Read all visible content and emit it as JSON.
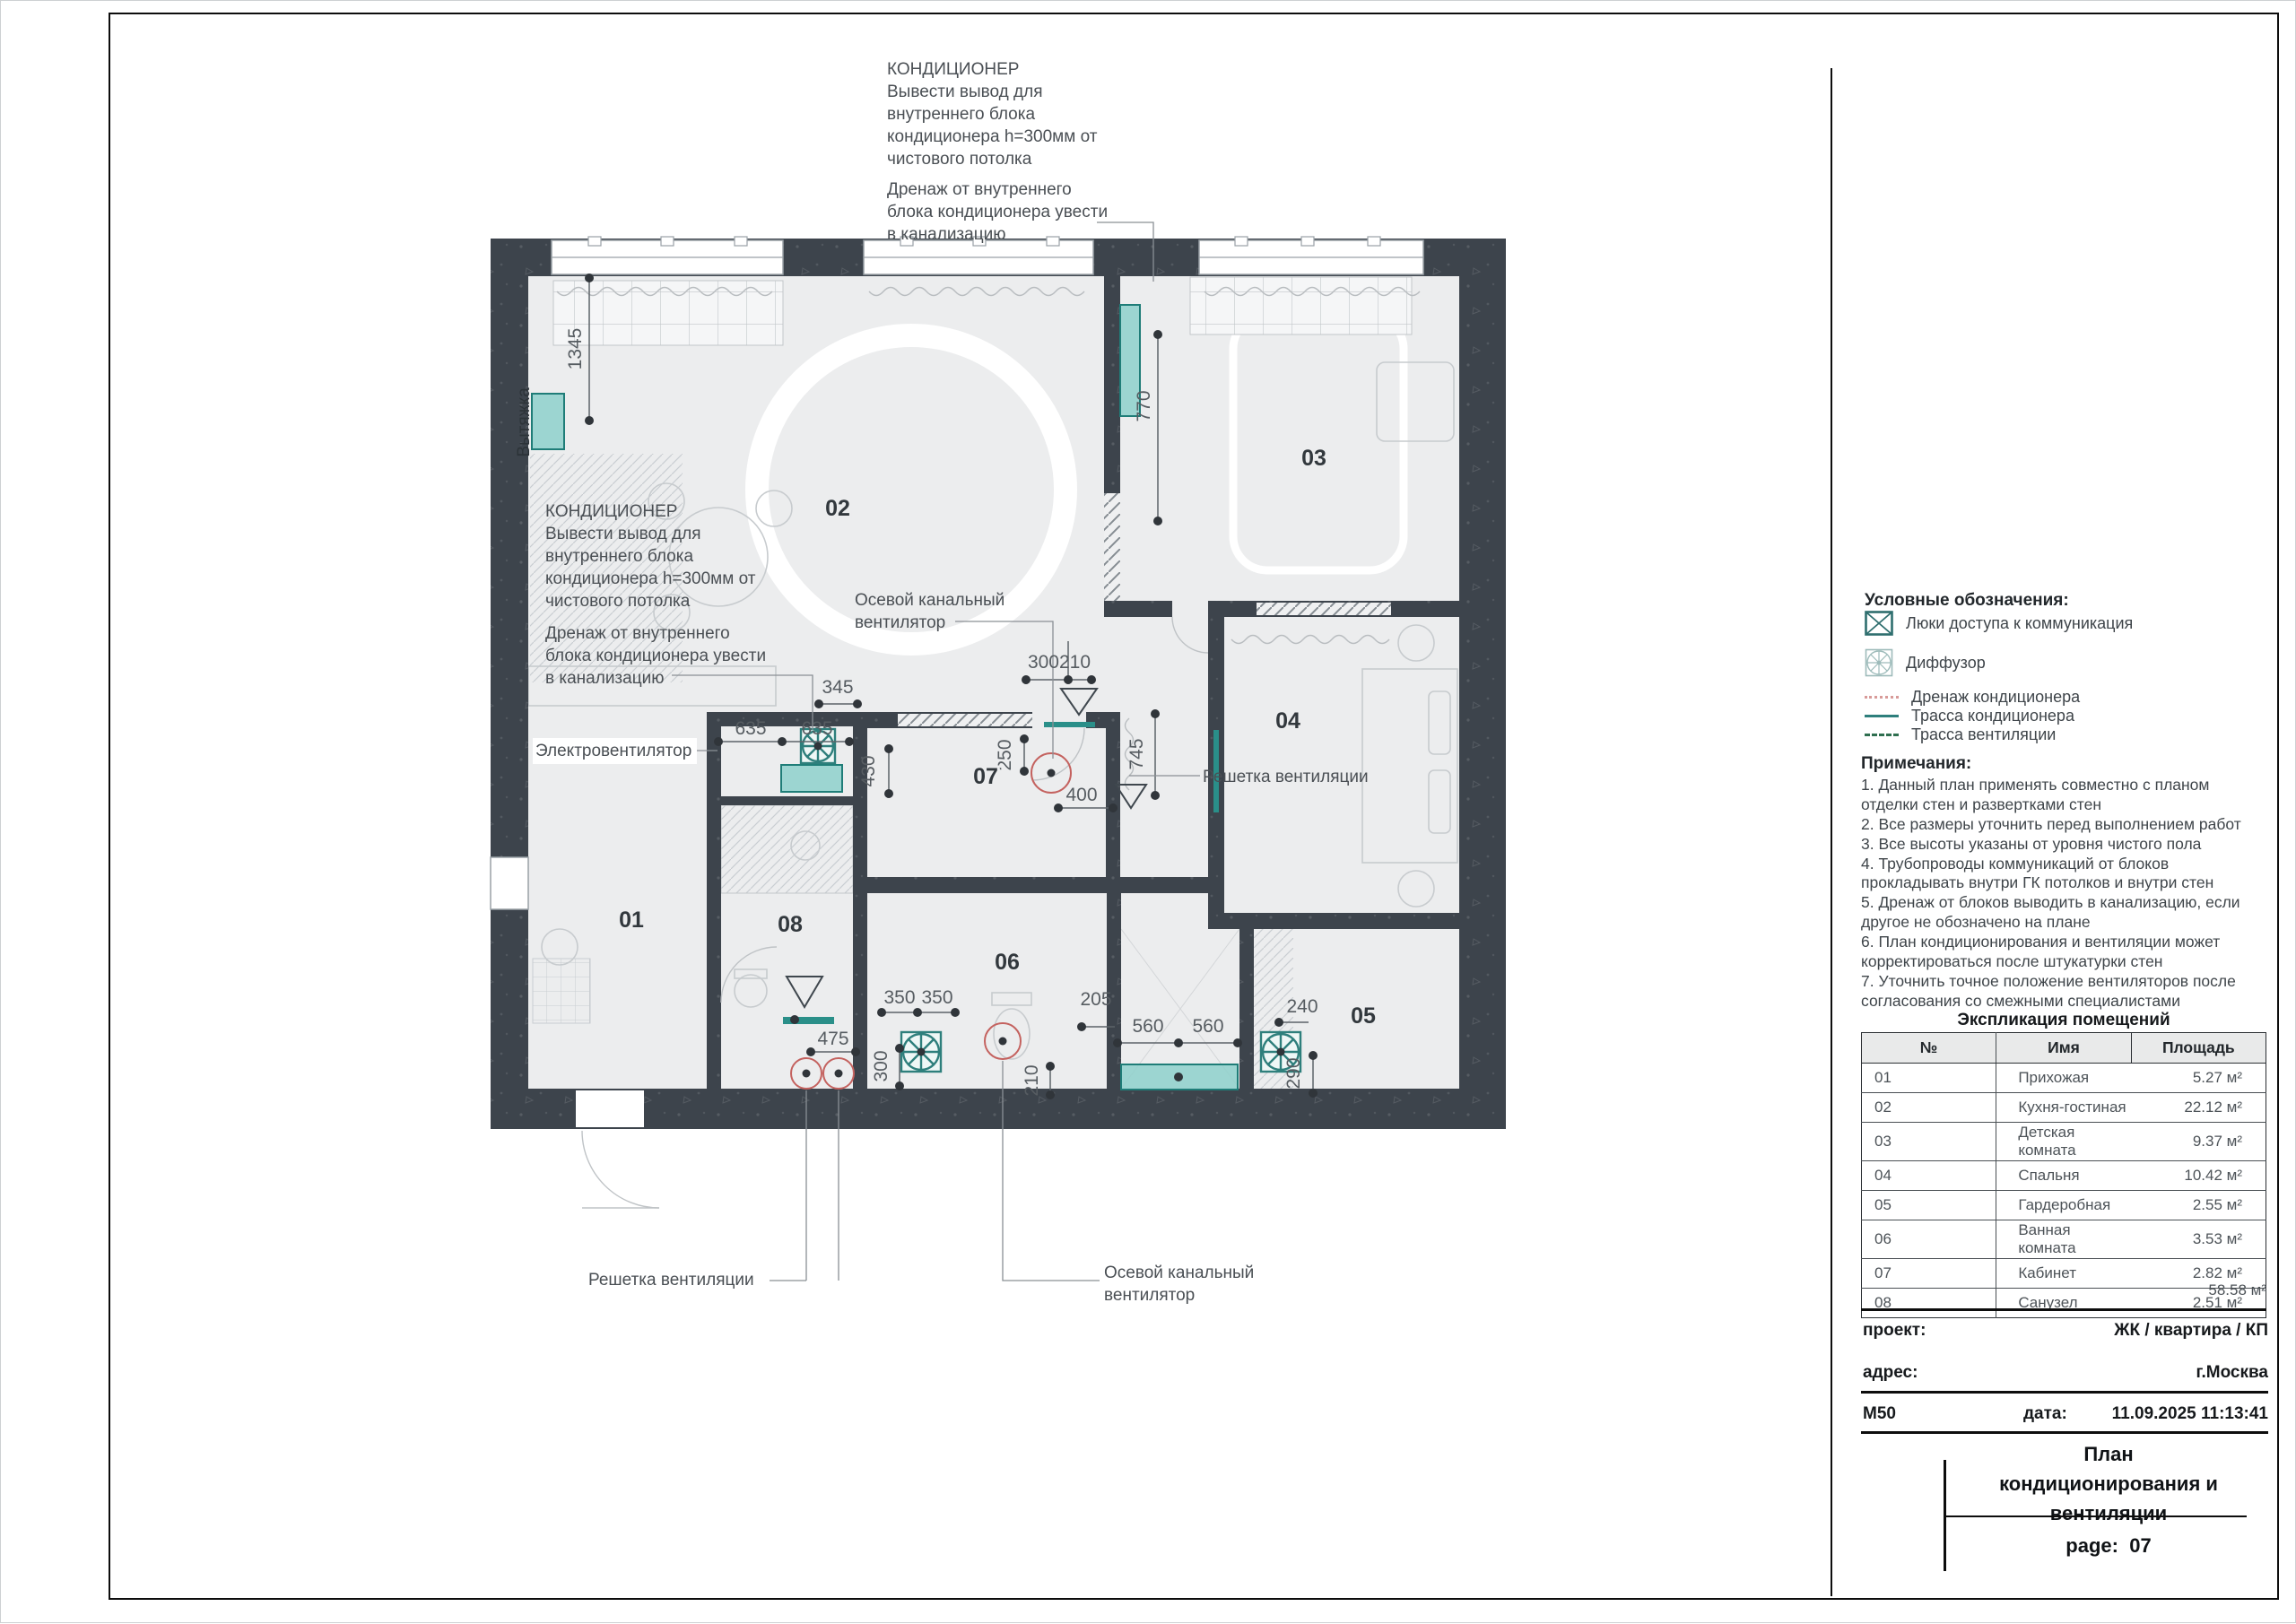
{
  "colors": {
    "wall": "#3d444c",
    "floor": "#ecedee",
    "teal_stroke": "#1f7d78",
    "teal_fill": "#8ed0cb",
    "red_marker": "#c4625f"
  },
  "plan": {
    "rooms": {
      "r01": "01",
      "r02": "02",
      "r03": "03",
      "r04": "04",
      "r05": "05",
      "r06": "06",
      "r07": "07",
      "r08": "08"
    },
    "dims": {
      "d1345": "1345",
      "d770": "770",
      "d345": "345",
      "d635a": "635",
      "d635b": "635",
      "d430": "430",
      "d250": "250",
      "d300210": "300210",
      "d400": "400",
      "d745": "745",
      "d350a": "350",
      "d350b": "350",
      "d300": "300",
      "d475": "475",
      "d205": "205",
      "d210": "210",
      "d560a": "560",
      "d560b": "560",
      "d240": "240",
      "d290": "290"
    },
    "labels": {
      "vytyazhka": "Вытяжка"
    }
  },
  "annotations": {
    "ac_top": "КОНДИЦИОНЕР\nВывести вывод для\nвнутреннего блока\nкондиционера h=300мм от\nчистового потолка",
    "drain_top": "Дренаж от внутреннего\nблока кондиционера увести\nв канализацию",
    "ac_left": "КОНДИЦИОНЕР\nВывести вывод для\nвнутреннего блока\nкондиционера h=300мм от\nчистового потолка",
    "drain_left": "Дренаж от внутреннего\nблока кондиционера увести\nв канализацию",
    "electro_fan": "Электровентилятор",
    "axial_fan_mid": "Осевой канальный\nвентилятор",
    "axial_fan_bottom": "Осевой канальный\nвентилятор",
    "vent_grille_right": "Решетка вентиляции",
    "vent_grille_bottom": "Решетка вентиляции"
  },
  "legend": {
    "heading": "Условные обозначения:",
    "items": [
      {
        "icon": "access-hatch-icon",
        "label": "Люки доступа к коммуникация"
      },
      {
        "icon": "diffuser-icon",
        "label": "Диффузор"
      },
      {
        "icon": "drain-line",
        "label": "Дренаж кондиционера"
      },
      {
        "icon": "ac-route-line",
        "label": "Трасса кондиционера"
      },
      {
        "icon": "vent-route-line",
        "label": "Трасса вентиляции"
      }
    ]
  },
  "notes": {
    "heading": "Примечания:",
    "text": "1. Данный план применять совместно с планом\n отделки стен и развертками стен\n2. Все размеры уточнить перед выполнением работ\n3. Все высоты указаны от уровня чистого пола\n4. Трубопроводы коммуникаций от блоков\n прокладывать внутри ГК потолков и внутри стен\n5. Дренаж от блоков выводить в канализацию, если\n другое не обозначено на плане\n6. План кондиционирования и вентиляции может\n корректироваться после штукатурки стен\n7. Уточнить точное положение вентиляторов после\n согласования со смежными специалистами"
  },
  "room_table": {
    "heading": "Экспликация помещений",
    "columns": [
      "№",
      "Имя",
      "Площадь"
    ],
    "rows": [
      [
        "01",
        "Прихожая",
        "5.27 м²"
      ],
      [
        "02",
        "Кухня-гостиная",
        "22.12 м²"
      ],
      [
        "03",
        "Детская комната",
        "9.37 м²"
      ],
      [
        "04",
        "Спальня",
        "10.42 м²"
      ],
      [
        "05",
        "Гардеробная",
        "2.55 м²"
      ],
      [
        "06",
        "Ванная комната",
        "3.53 м²"
      ],
      [
        "07",
        "Кабинет",
        "2.82 м²"
      ],
      [
        "08",
        "Санузел",
        "2.51 м²"
      ]
    ],
    "total": "58.58 м²"
  },
  "title_block": {
    "project_label": "проект:",
    "project_value": "ЖК / квартира / КП",
    "address_label": "адрес:",
    "address_value": "г.Москва",
    "scale": "М50",
    "date_label": "дата:",
    "date_value": "11.09.2025 11:13:41",
    "title": "План\nкондиционирования и\nвентиляции",
    "page_label": "page:",
    "page_value": "07"
  }
}
